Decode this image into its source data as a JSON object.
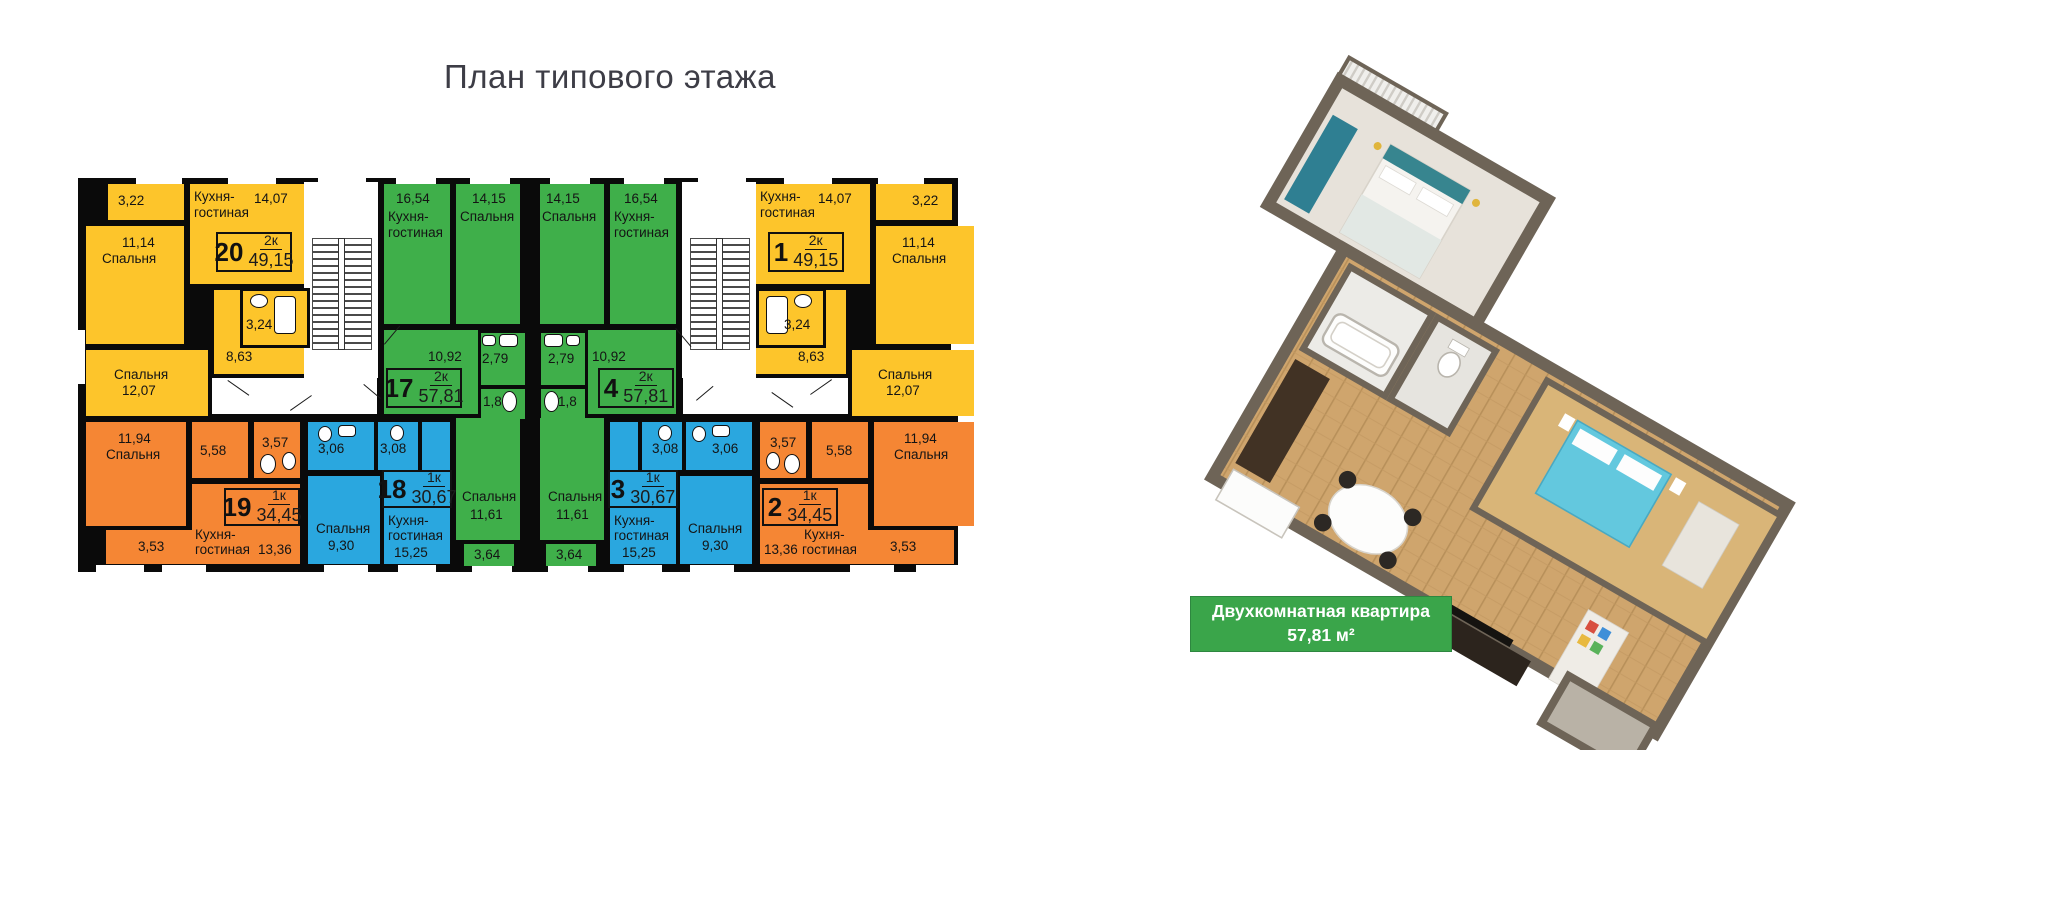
{
  "page": {
    "title": "План типового этажа"
  },
  "info_label": {
    "line1": "Двухкомнатная  квартира",
    "area": "57,81 м²",
    "bg": "#3aa54a"
  },
  "colors": {
    "apartment_2k_yellow": "#fdc52b",
    "apartment_1k_orange": "#f58634",
    "apartment_1k_blue": "#2aa7df",
    "apartment_2k_green": "#3faf4a",
    "walls": "#0a0a0a"
  },
  "plan": {
    "apartments": {
      "a20": {
        "num": "20",
        "type": "2к",
        "area": "49,15",
        "loggia": "3,22",
        "kitchen_name1": "Кухня-",
        "kitchen_name2": "гостиная",
        "kitchen_area": "14,07",
        "bed1_area": "11,14",
        "bed1_name": "Спальня",
        "bath": "3,24",
        "hall": "8,63",
        "bed2_name": "Спальня",
        "bed2_area": "12,07"
      },
      "a1": {
        "num": "1",
        "type": "2к",
        "area": "49,15",
        "loggia": "3,22",
        "kitchen_name1": "Кухня-",
        "kitchen_name2": "гостиная",
        "kitchen_area": "14,07",
        "bed1_area": "11,14",
        "bed1_name": "Спальня",
        "bath": "3,24",
        "hall": "8,63",
        "bed2_name": "Спальня",
        "bed2_area": "12,07"
      },
      "a17": {
        "num": "17",
        "type": "2к",
        "area": "57,81",
        "kitchen_area": "16,54",
        "kitchen_name1": "Кухня-",
        "kitchen_name2": "гостиная",
        "bed_top_area": "14,15",
        "bed_top_name": "Спальня",
        "hall": "10,92",
        "bath": "2,79",
        "wc": "1,8",
        "bed_bot_name": "Спальня",
        "bed_bot_area": "11,61",
        "balcony": "3,64"
      },
      "a4": {
        "num": "4",
        "type": "2к",
        "area": "57,81",
        "kitchen_area": "16,54",
        "kitchen_name1": "Кухня-",
        "kitchen_name2": "гостиная",
        "bed_top_area": "14,15",
        "bed_top_name": "Спальня",
        "hall": "10,92",
        "bath": "2,79",
        "wc": "1,8",
        "bed_bot_name": "Спальня",
        "bed_bot_area": "11,61",
        "balcony": "3,64"
      },
      "a19": {
        "num": "19",
        "type": "1к",
        "area": "34,45",
        "bed_area": "11,94",
        "bed_name": "Спальня",
        "hall": "5,58",
        "wc": "3,57",
        "kitchen_name1": "Кухня-",
        "kitchen_name2": "гостиная",
        "kitchen_area": "13,36",
        "loggia": "3,53"
      },
      "a2": {
        "num": "2",
        "type": "1к",
        "area": "34,45",
        "bed_area": "11,94",
        "bed_name": "Спальня",
        "hall": "5,58",
        "wc": "3,57",
        "kitchen_name1": "Кухня-",
        "kitchen_name2": "гостиная",
        "kitchen_area": "13,36",
        "loggia": "3,53"
      },
      "a18": {
        "num": "18",
        "type": "1к",
        "area": "30,67",
        "wc_left": "3,06",
        "wc_right": "3,08",
        "bed_name": "Спальня",
        "bed_area": "9,30",
        "kitchen_name1": "Кухня-",
        "kitchen_name2": "гостиная",
        "kitchen_area": "15,25"
      },
      "a3": {
        "num": "3",
        "type": "1к",
        "area": "30,67",
        "wc_left": "3,08",
        "wc_right": "3,06",
        "bed_name": "Спальня",
        "bed_area": "9,30",
        "kitchen_name1": "Кухня-",
        "kitchen_name2": "гостиная",
        "kitchen_area": "15,25"
      }
    }
  }
}
